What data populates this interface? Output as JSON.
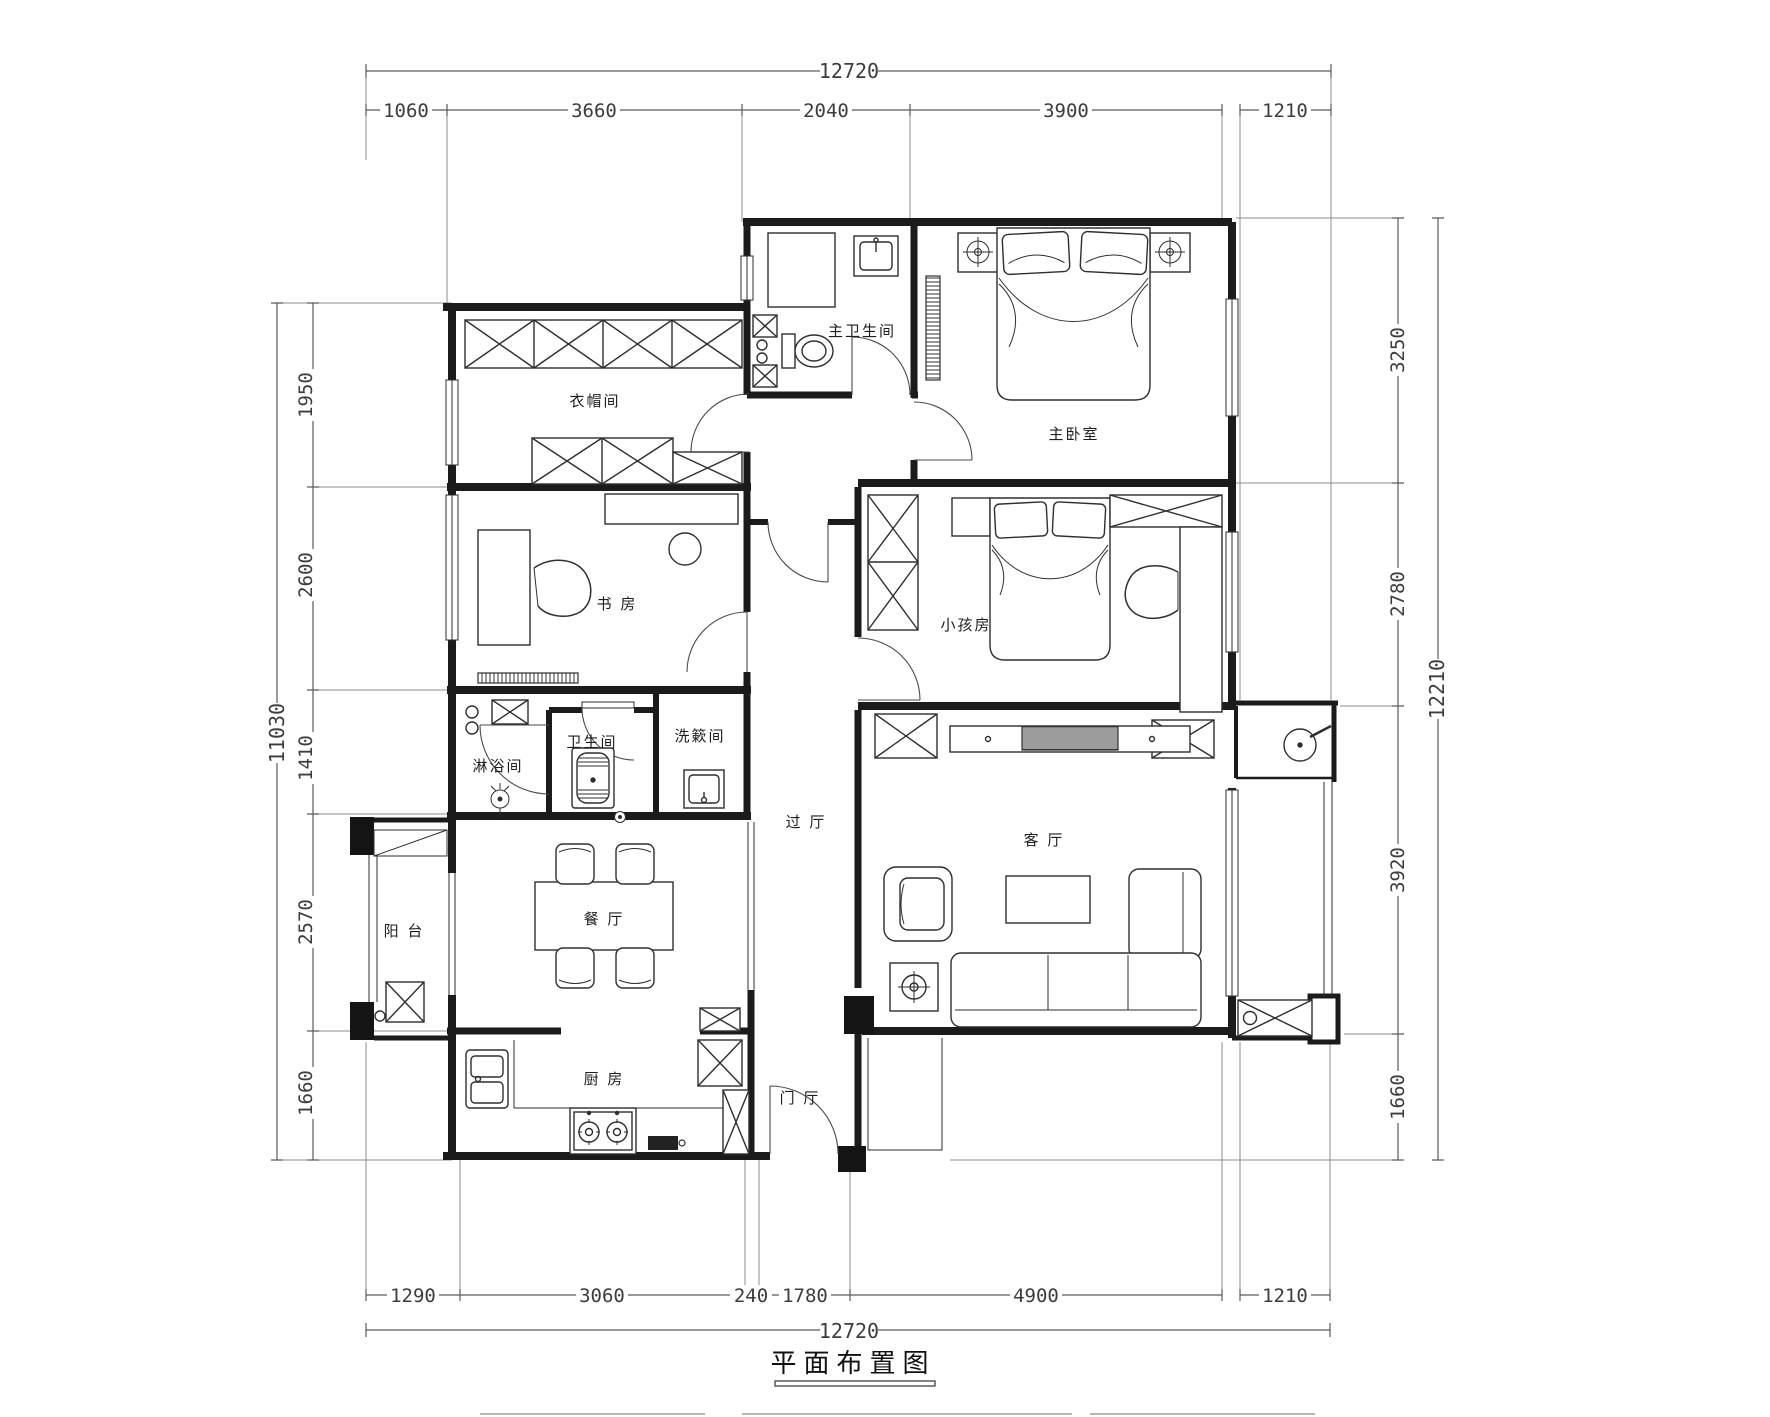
{
  "title": {
    "text": "平面布置图"
  },
  "dimensions": {
    "top": {
      "total": "12720",
      "segments": [
        "1060",
        "3660",
        "2040",
        "3900",
        "1210"
      ]
    },
    "bottom": {
      "total": "12720",
      "segments": [
        "1290",
        "3060",
        "240",
        "1780",
        "4900",
        "1210"
      ]
    },
    "left": {
      "total": "11030",
      "segments": [
        "1950",
        "2600",
        "1410",
        "2570",
        "1660"
      ]
    },
    "right": {
      "total": "12210",
      "segments": [
        "3250",
        "2780",
        "3920",
        "1660"
      ]
    }
  },
  "rooms": {
    "cloakroom": "衣帽间",
    "master_bathroom": "主卫生间",
    "master_bedroom": "主卧室",
    "study": "书 房",
    "kids_room": "小孩房",
    "shower_room": "淋浴间",
    "bathroom": "卫生间",
    "laundry_room": "洗簌间",
    "hallway": "过 厅",
    "living_room": "客 厅",
    "dining_room": "餐 厅",
    "balcony": "阳 台",
    "kitchen": "厨 房",
    "foyer": "门 厅"
  },
  "colors": {
    "background": "#ffffff",
    "wall": "#1b1b1b",
    "furniture": "#2e2e2e",
    "dimension_line": "#5a5a5a",
    "dimension_text": "#3c3c3c"
  }
}
